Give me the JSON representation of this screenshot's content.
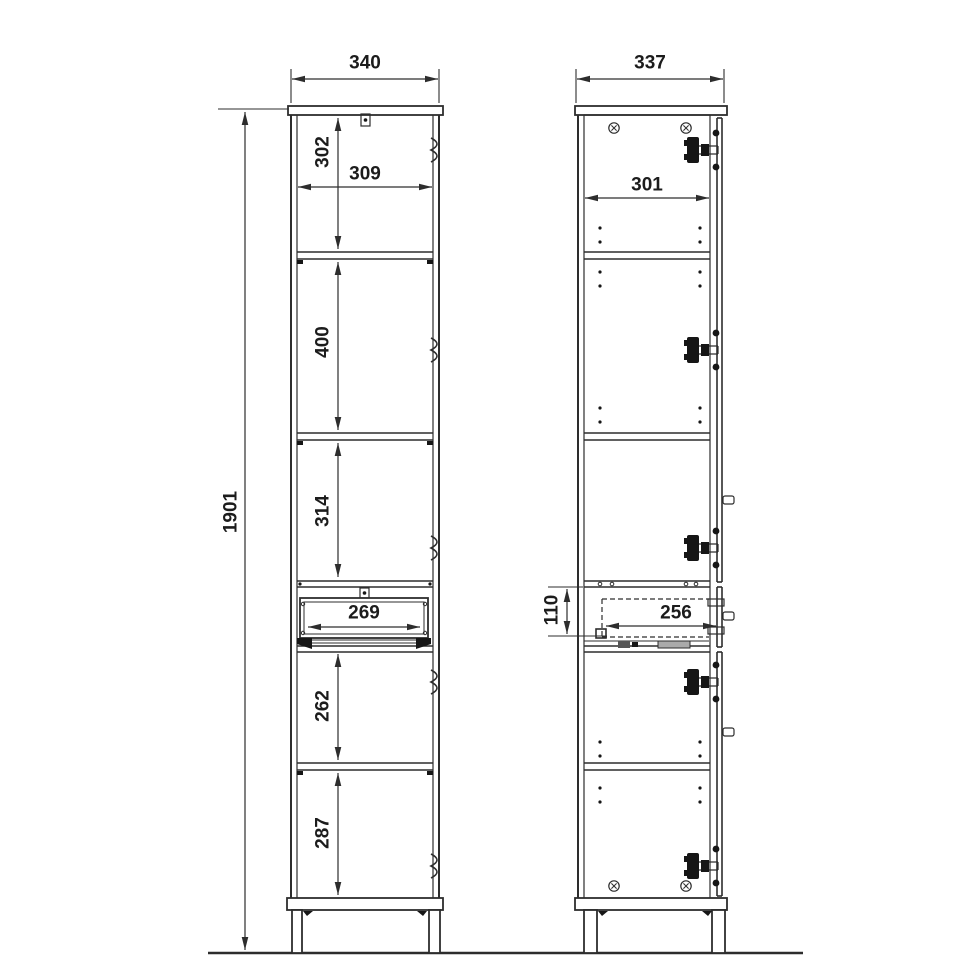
{
  "drawing": {
    "type": "furniture technical drawing, tall cabinet, front and side elevation with dimensions",
    "front_view": {
      "overall_width": "340",
      "overall_height": "1901",
      "top_compartment_height": "302",
      "inner_width": "309",
      "upper_middle_compartment_height": "400",
      "lower_middle_compartment_height": "314",
      "drawer_opening_width": "269",
      "below_drawer_compartment_height": "262",
      "bottom_compartment_height": "287"
    },
    "side_view": {
      "overall_depth": "337",
      "inner_depth": "301",
      "drawer_front_height": "110",
      "drawer_inner_depth": "256"
    }
  },
  "colors": {
    "line": "#2d2d2d",
    "background": "#ffffff",
    "text": "#1c1c1c"
  },
  "icons": {
    "hinge-icon": "concealed cup hinge hardware (black plate with arm and two dots)",
    "hinge-mark-icon": "brace-like hinge mark on door edge",
    "screw-icon": "circle with cross (cam screw head)",
    "knob-icon": "small protruding handle stub",
    "shelf-pin-hole": "small round shelf pin hole",
    "cam-fitting-icon": "small rectangular cam fitting with dot"
  }
}
